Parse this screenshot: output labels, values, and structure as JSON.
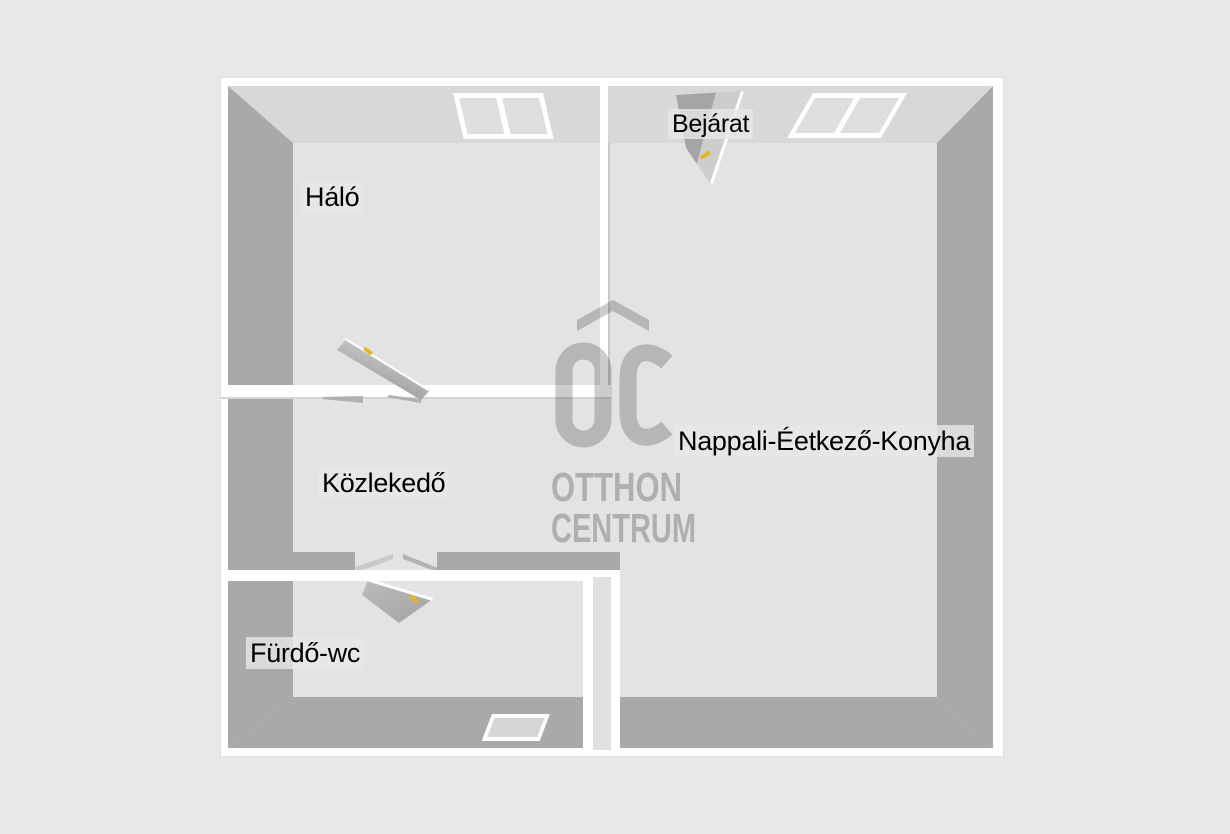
{
  "plan": {
    "type": "floor-plan-3d-top-view",
    "rooms": [
      {
        "name": "Háló"
      },
      {
        "name": "Bejárat"
      },
      {
        "name": "Nappali-Éetkező-Konyha"
      },
      {
        "name": "Közlekedő"
      },
      {
        "name": "Fürdő-wc"
      }
    ]
  },
  "watermark": {
    "monogram": "OC",
    "line1": "OTTHON",
    "line2": "CENTRUM"
  },
  "colors": {
    "background": "#e8e8e8",
    "floor": "#e3e3e3",
    "ceiling_band": "#d8d8d8",
    "wall_face": "#a9a9a9",
    "wall_line": "#ffffff",
    "label_text": "#000000",
    "door_handle": "#e8b51e",
    "watermark_gray": "#b3b3b3"
  }
}
